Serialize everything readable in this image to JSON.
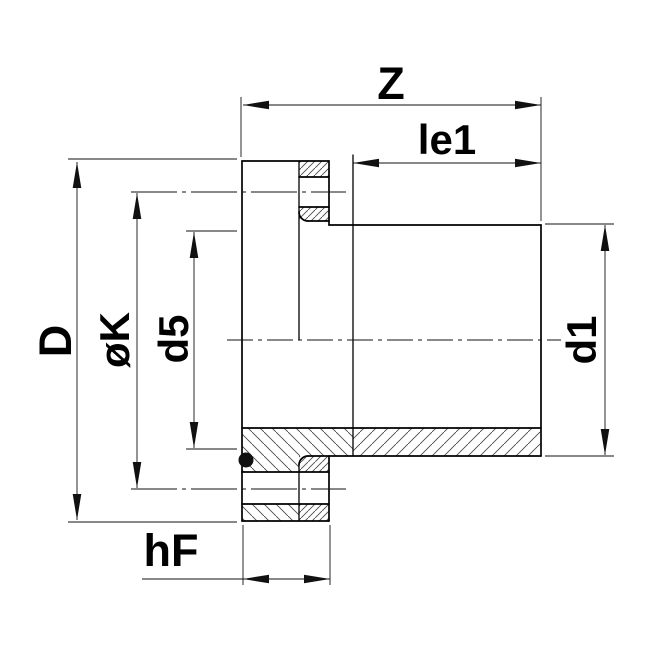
{
  "drawing": {
    "type": "technical-drawing-cross-section",
    "description": "Flange adaptor cross-section with dimension callouts",
    "background_color": "#ffffff",
    "outline_color": "#000000",
    "dim_color": "#111111",
    "hatch_color": "#4a4a4a",
    "oring_color": "#111111",
    "labels": {
      "z": "Z",
      "le1": "le1",
      "d_big": "D",
      "ok": "øK",
      "d5": "d5",
      "d1": "d1",
      "hf": "hF"
    }
  }
}
